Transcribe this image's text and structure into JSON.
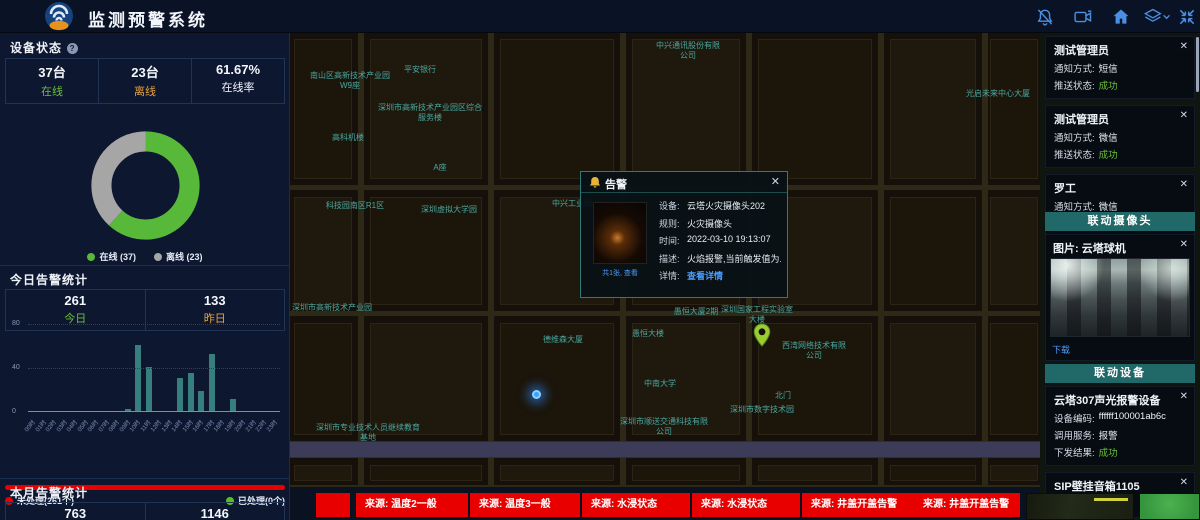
{
  "header": {
    "title": "监测预警系统",
    "icons": [
      {
        "name": "bell-off-icon"
      },
      {
        "name": "video-camera-icon"
      },
      {
        "name": "home-icon"
      },
      {
        "name": "layers-icon"
      },
      {
        "name": "chevron-down-icon"
      },
      {
        "name": "fullscreen-icon"
      }
    ]
  },
  "device_status": {
    "title": "设备状态",
    "stats": [
      {
        "value": "37台",
        "label": "在线",
        "color_class": "green"
      },
      {
        "value": "23台",
        "label": "离线",
        "color_class": "orange"
      },
      {
        "value": "61.67%",
        "label": "在线率",
        "color_class": "white"
      }
    ],
    "chart_data": {
      "type": "pie",
      "donut": true,
      "series": [
        {
          "name": "在线",
          "value": 37,
          "color": "#57b83a"
        },
        {
          "name": "离线",
          "value": 23,
          "color": "#a6a6a6"
        }
      ],
      "legend": [
        "在线 (37)",
        "离线 (23)"
      ],
      "online_rate": "61.67%"
    }
  },
  "today_alerts": {
    "title": "今日告警统计",
    "stats": [
      {
        "value": "261",
        "label": "今日",
        "color_class": "green"
      },
      {
        "value": "133",
        "label": "昨日",
        "color_class": "orange"
      }
    ],
    "chart_data": {
      "type": "bar",
      "categories": [
        "00时",
        "01时",
        "02时",
        "03时",
        "04时",
        "05时",
        "06时",
        "07时",
        "08时",
        "09时",
        "10时",
        "11时",
        "12时",
        "13时",
        "14时",
        "15时",
        "16时",
        "17时",
        "18时",
        "19时",
        "20时",
        "21时",
        "22时",
        "23时"
      ],
      "values": [
        0,
        0,
        0,
        0,
        0,
        0,
        0,
        0,
        0,
        2,
        60,
        40,
        0,
        0,
        30,
        35,
        18,
        52,
        0,
        11,
        0,
        0,
        0,
        0
      ],
      "ylim": [
        0,
        80
      ],
      "yticks": [
        0,
        40,
        80
      ],
      "bar_color": "#377e7e",
      "grid": "dotted horizontal"
    },
    "progress_legend": {
      "unhandled": "未处理(261个)",
      "handled": "已处理(0个)"
    },
    "progress_colors": {
      "unhandled": "#e80000",
      "handled": "#52c41a"
    }
  },
  "month_alerts": {
    "title": "本月告警统计",
    "stats": [
      {
        "value": "763"
      },
      {
        "value": "1146"
      }
    ]
  },
  "map": {
    "popup": {
      "title": "告警",
      "thumb_caption": "共1张, 查看",
      "rows": [
        {
          "label": "设备:",
          "value": "云塔火灾摄像头202"
        },
        {
          "label": "规则:",
          "value": "火灾摄像头"
        },
        {
          "label": "时间:",
          "value": "2022-03-10 19:13:07"
        },
        {
          "label": "描述:",
          "value": "火焰报警,当前触发值为..."
        },
        {
          "label": "详情:",
          "value": "查看详情",
          "link": true
        }
      ]
    },
    "labels": [
      {
        "text": "中兴通讯股份有限公司",
        "x": 366,
        "y": 8,
        "w": 64
      },
      {
        "text": "平安银行",
        "x": 100,
        "y": 32,
        "w": 60
      },
      {
        "text": "南山区高新技术产业园W9座",
        "x": 16,
        "y": 38,
        "w": 88
      },
      {
        "text": "光启未来中心大厦",
        "x": 666,
        "y": 56,
        "w": 84
      },
      {
        "text": "深圳市高新技术产业园区综合服务楼",
        "x": 88,
        "y": 70,
        "w": 104
      },
      {
        "text": "高科机楼",
        "x": 28,
        "y": 100,
        "w": 60
      },
      {
        "text": "A座",
        "x": 130,
        "y": 130,
        "w": 40
      },
      {
        "text": "科技园南区R1区",
        "x": 14,
        "y": 168,
        "w": 102
      },
      {
        "text": "深圳虚拟大学园",
        "x": 108,
        "y": 172,
        "w": 102
      },
      {
        "text": "中兴工业园",
        "x": 246,
        "y": 166,
        "w": 72
      },
      {
        "text": "深圳市高新技术产业园",
        "x": 2,
        "y": 270,
        "w": 80
      },
      {
        "text": "德维森大厦",
        "x": 238,
        "y": 302,
        "w": 70
      },
      {
        "text": "愚恒大楼",
        "x": 328,
        "y": 296,
        "w": 60
      },
      {
        "text": "愚恒大厦2期",
        "x": 366,
        "y": 274,
        "w": 80
      },
      {
        "text": "深圳国家工程实验室大楼",
        "x": 428,
        "y": 272,
        "w": 78
      },
      {
        "text": "西湾网络技术有限公司",
        "x": 490,
        "y": 308,
        "w": 68
      },
      {
        "text": "中南大学",
        "x": 340,
        "y": 346,
        "w": 60
      },
      {
        "text": "北门",
        "x": 478,
        "y": 358,
        "w": 30
      },
      {
        "text": "深圳市数字技术园",
        "x": 418,
        "y": 372,
        "w": 108
      },
      {
        "text": "深圳市顺送交通科技有限公司",
        "x": 328,
        "y": 384,
        "w": 92
      },
      {
        "text": "深圳市专业技术人员继续教育基地",
        "x": 26,
        "y": 390,
        "w": 104
      }
    ],
    "markers": [
      {
        "type": "blue-dot",
        "x": 242,
        "y": 357
      },
      {
        "type": "green-pin",
        "x": 463,
        "y": 290
      }
    ]
  },
  "right_panel": {
    "labels": {
      "method": "通知方式:",
      "status": "推送状态:"
    },
    "notifications": [
      {
        "name": "测试管理员",
        "method": "短信",
        "status": "成功"
      },
      {
        "name": "测试管理员",
        "method": "微信",
        "status": "成功"
      },
      {
        "name": "罗工",
        "method": "微信",
        "status": "成功"
      }
    ],
    "camera_section": {
      "title": "联动摄像头",
      "card": {
        "title": "图片: 云塔球机",
        "download_label": "下载"
      }
    },
    "device_section": {
      "title": "联动设备",
      "cards": [
        {
          "title": "云塔307声光报警设备",
          "rows": [
            {
              "label": "设备编码:",
              "value": "ffffff100001ab6c"
            },
            {
              "label": "调用服务:",
              "value": "报警"
            },
            {
              "label": "下发结果:",
              "value": "成功",
              "status": true
            }
          ]
        },
        {
          "title": "SIP壁挂音箱1105",
          "rows": [
            {
              "label": "设备编码:",
              "value": "1106"
            }
          ]
        }
      ]
    }
  },
  "ticker": {
    "items": [
      "来源: 温度2一般",
      "来源: 温度3一般",
      "来源: 水浸状态",
      "来源: 水浸状态",
      "来源: 井盖开盖告警",
      "来源: 井盖开盖告警"
    ],
    "alert_color": "#e80000"
  }
}
